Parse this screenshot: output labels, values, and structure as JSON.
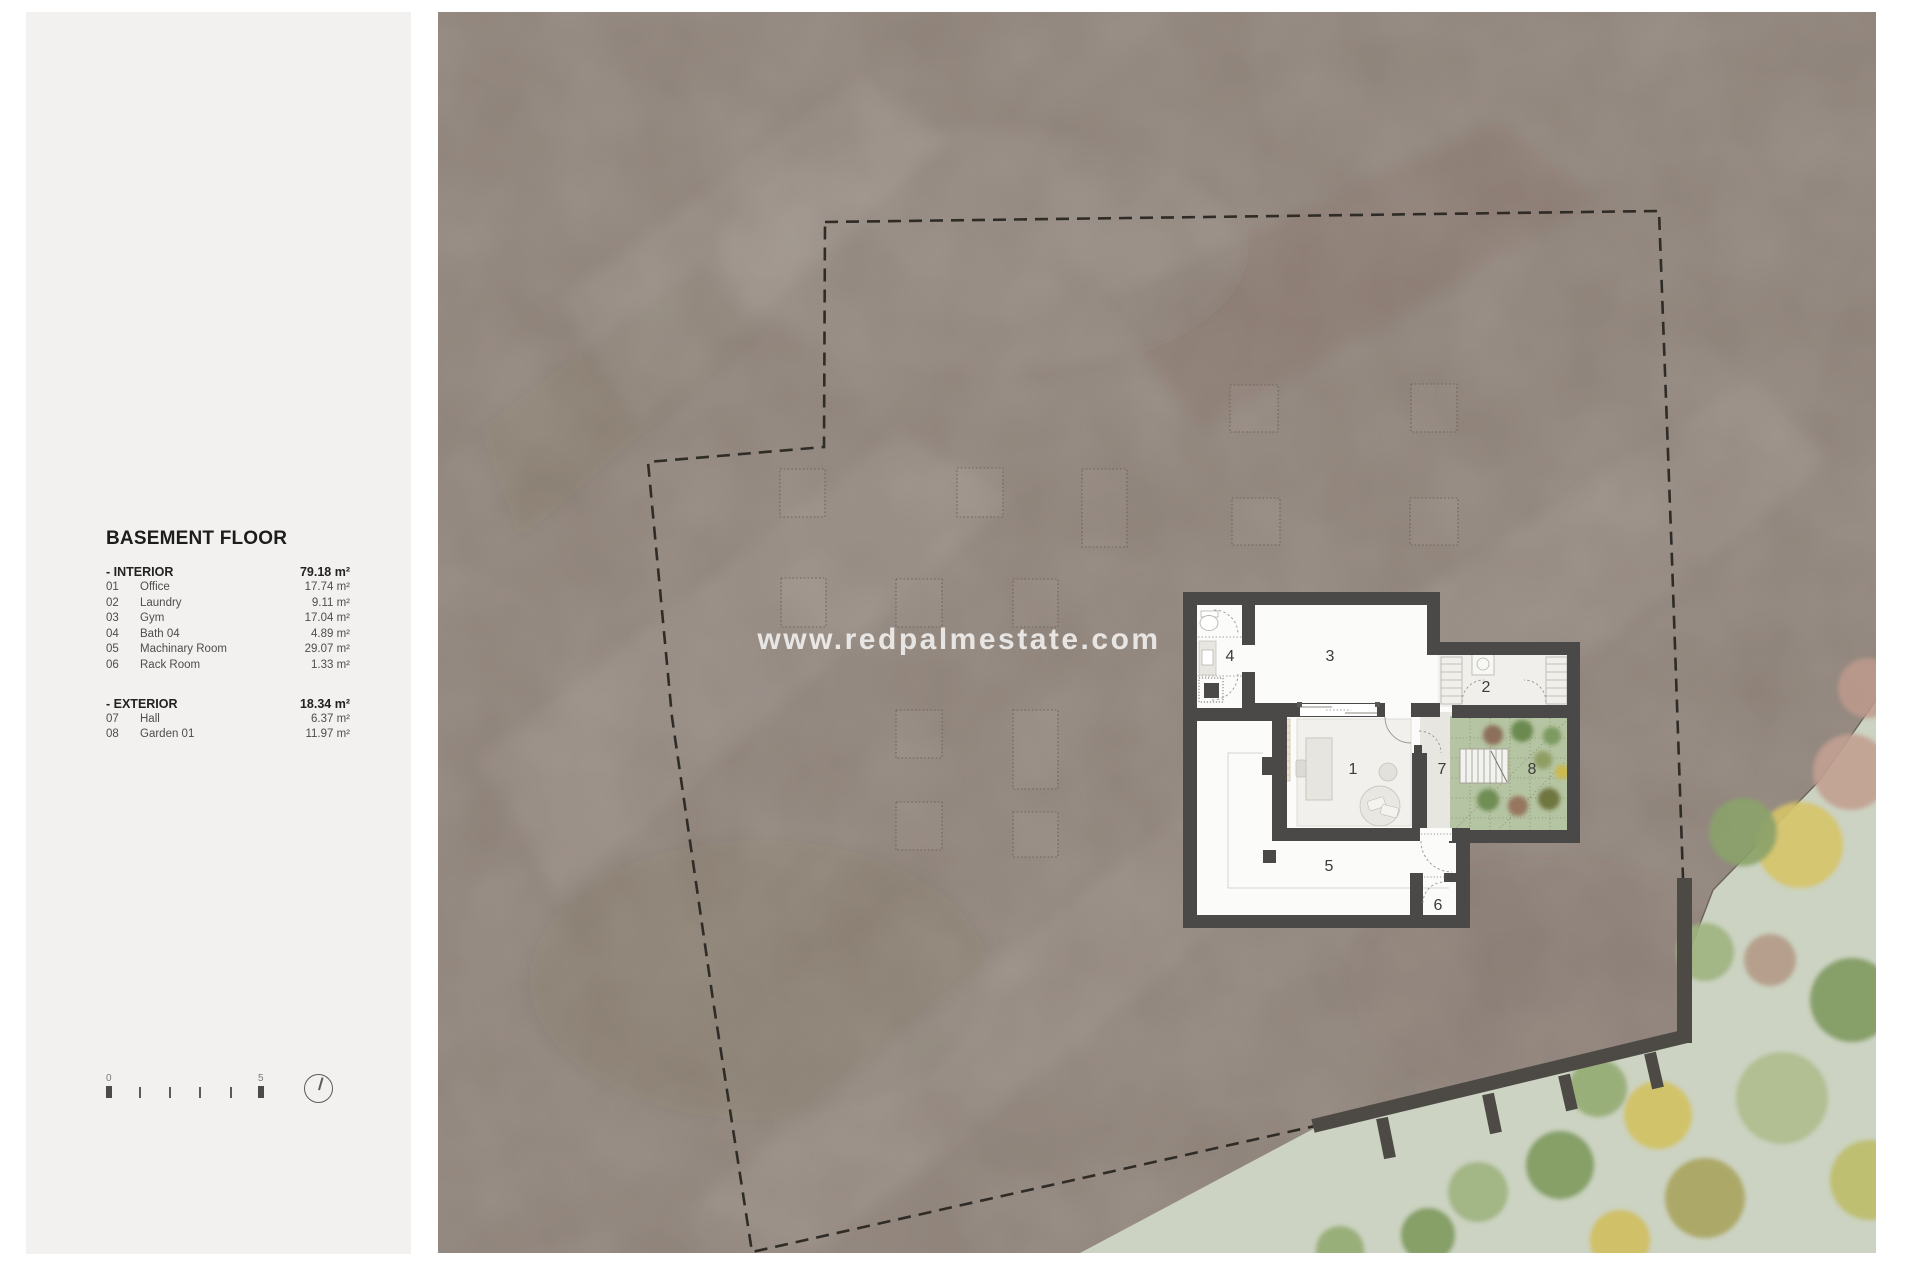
{
  "sidebar": {
    "title": "BASEMENT FLOOR",
    "interior": {
      "label": "- INTERIOR",
      "total": "79.18 m²",
      "rows": [
        {
          "num": "01",
          "name": "Office",
          "area": "17.74 m²"
        },
        {
          "num": "02",
          "name": "Laundry",
          "area": "9.11 m²"
        },
        {
          "num": "03",
          "name": "Gym",
          "area": "17.04 m²"
        },
        {
          "num": "04",
          "name": "Bath 04",
          "area": "4.89 m²"
        },
        {
          "num": "05",
          "name": "Machinary Room",
          "area": "29.07 m²"
        },
        {
          "num": "06",
          "name": "Rack Room",
          "area": "1.33 m²"
        }
      ]
    },
    "exterior": {
      "label": "- EXTERIOR",
      "total": "18.34 m²",
      "rows": [
        {
          "num": "07",
          "name": "Hall",
          "area": "6.37 m²"
        },
        {
          "num": "08",
          "name": "Garden 01",
          "area": "11.97 m²"
        }
      ]
    },
    "scalebar": {
      "start": "0",
      "end": "5"
    }
  },
  "map": {
    "watermark": "www.redpalmestate.com",
    "rooms": [
      {
        "num": "1"
      },
      {
        "num": "2"
      },
      {
        "num": "3"
      },
      {
        "num": "4"
      },
      {
        "num": "5"
      },
      {
        "num": "6"
      },
      {
        "num": "7"
      },
      {
        "num": "8"
      }
    ]
  },
  "colors": {
    "sidebar_bg": "#f2f1ef",
    "terrain_taupe": "#8d8178",
    "terrain_green": "#ccd3c2",
    "wall_dark": "#4a4947",
    "garden_green": "#b5c4a2",
    "boundary_dash": "#2f2b27"
  }
}
